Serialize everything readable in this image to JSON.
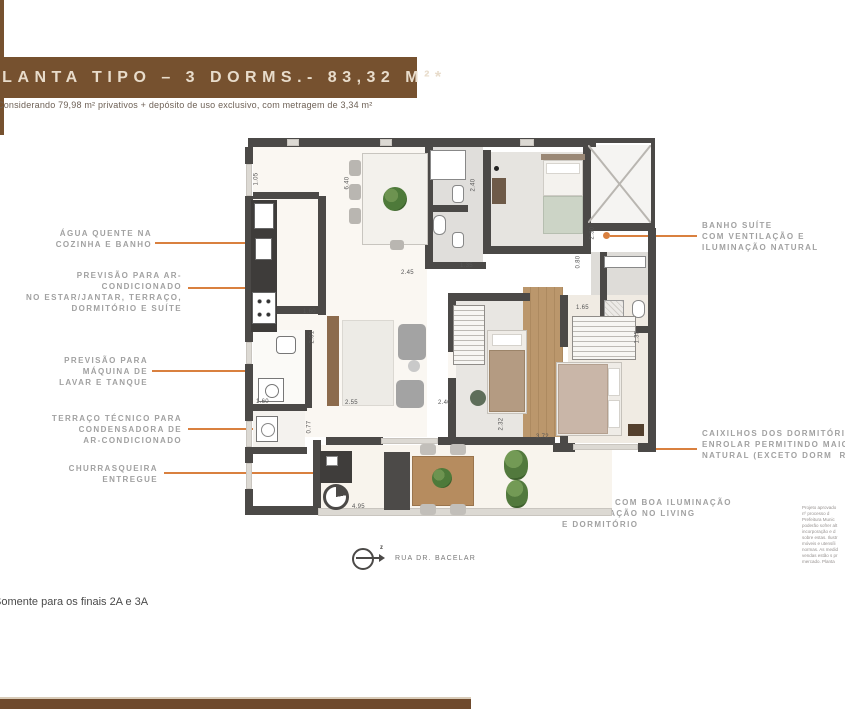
{
  "page": {
    "title": "PLANTA TIPO – 3 DORMS.- 83,32 M²*",
    "subtitle": "Considerando 79,98 m² privativos + depósito de uso exclusivo, com metragem de 3,34 m²",
    "footnote": "Somente para os finais 2A e 3A",
    "street_label": "RUA DR. BACELAR",
    "compass_mark": "z"
  },
  "colors": {
    "brand_brown": "#76512f",
    "accent_orange": "#d9803f",
    "wall_gray": "#4b4947",
    "label_gray": "#a1a1a1"
  },
  "callouts": {
    "left": [
      {
        "text": "ÁGUA QUENTE NA\nCOZINHA E BANHO"
      },
      {
        "text": "PREVISÃO PARA AR-CONDICIONADO\nNO ESTAR/JANTAR, TERRAÇO,\nDORMITÓRIO E SUÍTE"
      },
      {
        "text": "PREVISÃO PARA\nMÁQUINA DE\nLAVAR E TANQUE"
      },
      {
        "text": "TERRAÇO TÉCNICO PARA\nCONDENSADORA DE\nAR-CONDICIONADO"
      },
      {
        "text": "CHURRASQUEIRA\nENTREGUE"
      }
    ],
    "right": [
      {
        "text": "BANHO SUÍTE\nCOM VENTILAÇÃO E\nILUMINAÇÃO NATURAL"
      },
      {
        "text": "CAIXILHOS DOS DORMITÓRIOS,\nENROLAR PERMITINDO MAIOR I\nNATURAL (EXCETO DORM  REVE"
      },
      {
        "text": "TERRAÇO COM BOA ILUMINAÇÃO\nE VENTILAÇÃO NO LIVING\nE DORMITÓRIO"
      }
    ]
  },
  "plan": {
    "dimensions": [
      "1.05",
      "2.45",
      "1.35",
      "2.40",
      "2.30",
      "0.80",
      "1.60",
      "2.01",
      "1.60",
      "0.77",
      "2.55",
      "2.40",
      "2.32",
      "1.65",
      "1.35",
      "3.72",
      "4.95",
      "6.40"
    ]
  },
  "fine_print": {
    "text": "Projeto aprovado\nnº processo d\nPrefeitura Munic\npoderão sofrer alt\nincorporação e d\nsobre estas. Ilustr\nmóveis e utensíli\nnormas. As medid\nvendas estão s pr\nmercado. Planta"
  }
}
